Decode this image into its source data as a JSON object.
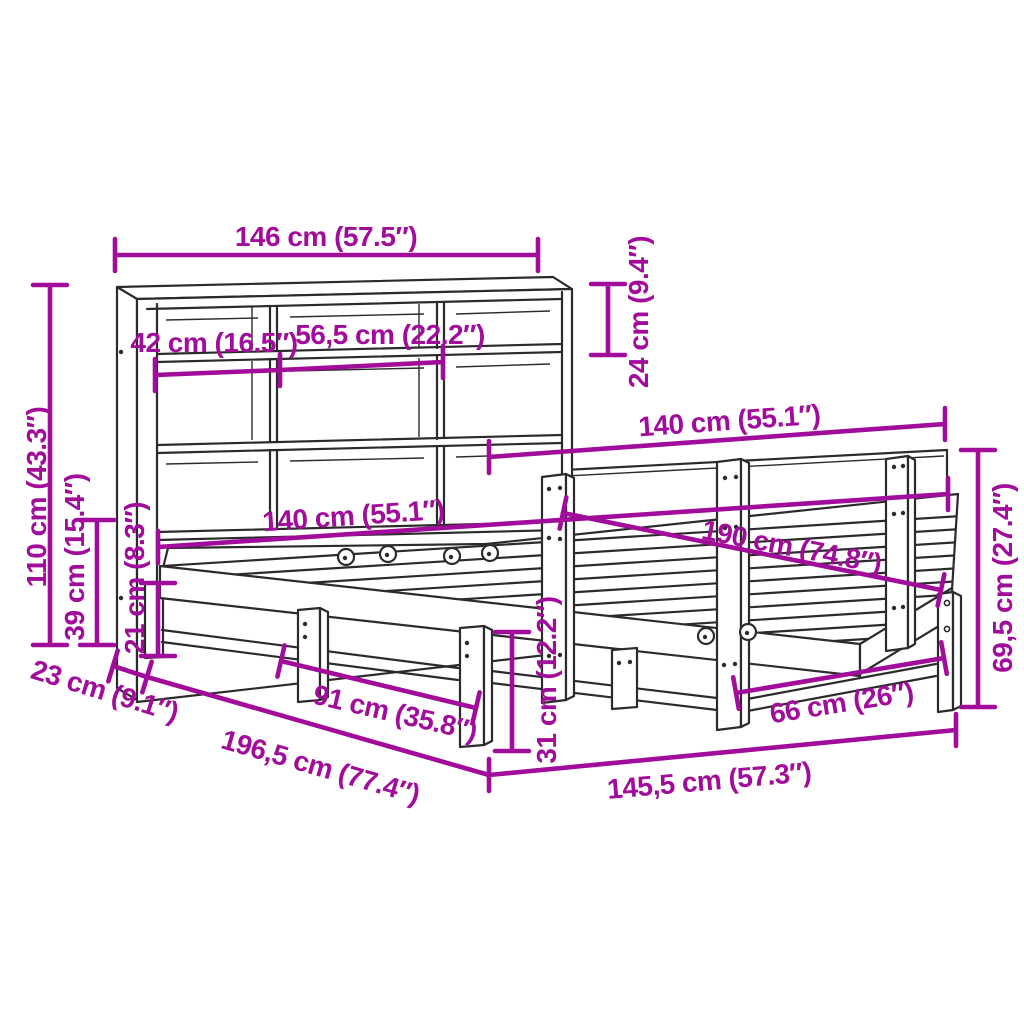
{
  "diagram": {
    "subject": "Bookcase bed frame with shelving headboard - product dimension diagram",
    "background_color": "#ffffff",
    "outline_color": "#2b2b2b",
    "dimension_color": "#A10C9B"
  },
  "dimensions": {
    "bookcase_width": "146 cm (57.5″)",
    "top_shelf_height": "24 cm (9.4″)",
    "compartment_left_width": "42 cm (16.5″)",
    "compartment_middle_width": "56,5 cm (22.2″)",
    "headboard_width": "140 cm (55.1″)",
    "bookcase_height": "110 cm (43.3″)",
    "lower_shelf_height": "39 cm (15.4″)",
    "base_rail_height": "21 cm (8.3″)",
    "bed_width": "140 cm (55.1″)",
    "bed_length": "190 cm (74.8″)",
    "headboard_panel_height": "69,5 cm (27.4″)",
    "bookcase_depth": "23 cm (9.1″)",
    "total_length": "196,5 cm (77.4″)",
    "front_leg_spacing": "91 cm (35.8″)",
    "frame_height": "31 cm (12.2″)",
    "rear_leg_spacing": "66 cm (26″)",
    "frame_width": "145,5 cm (57.3″)"
  }
}
